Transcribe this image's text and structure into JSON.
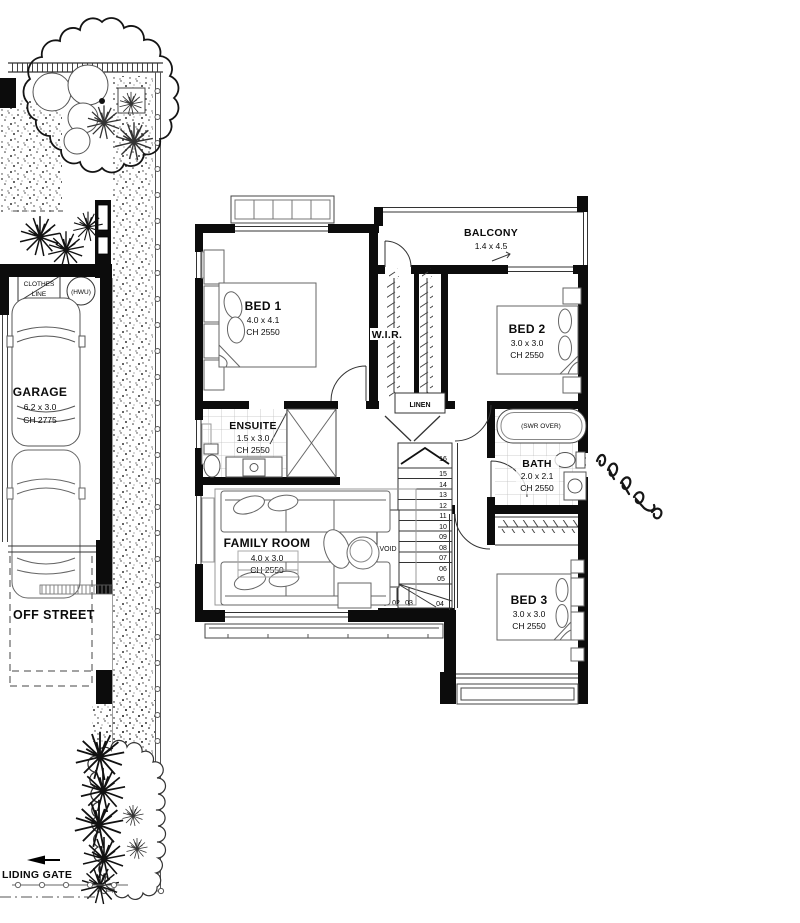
{
  "site": {
    "clothes_line_1": "CLOTHES",
    "clothes_line_2": "LINE",
    "hwu_label": "(HWU)",
    "garage_name": "GARAGE",
    "garage_size": "6.2 x 3.0",
    "garage_ch": "CH 2775",
    "off_street": "OFF STREET",
    "gate_label": "LIDING GATE"
  },
  "plan": {
    "balcony_name": "BALCONY",
    "balcony_size": "1.4 x 4.5",
    "bed1_name": "BED 1",
    "bed1_size": "4.0 x 4.1",
    "bed1_ch": "CH 2550",
    "bed2_name": "BED 2",
    "bed2_size": "3.0 x 3.0",
    "bed2_ch": "CH 2550",
    "bed3_name": "BED 3",
    "bed3_size": "3.0 x 3.0",
    "bed3_ch": "CH 2550",
    "family_name": "FAMILY ROOM",
    "family_size": "4.0 x 3.0",
    "family_ch": "CH 2550",
    "ensuite_name": "ENSUITE",
    "ensuite_size": "1.5 x 3.0",
    "ensuite_ch": "CH 2550",
    "bath_name": "BATH",
    "bath_size": "2.0 x 2.1",
    "bath_ch": "CH 2550",
    "wir": "W.I.R.",
    "linen": "LINEN",
    "void": "VOID",
    "swr": "(SWR OVER)",
    "stairs": [
      "01",
      "02",
      "03",
      "04",
      "05",
      "06",
      "07",
      "08",
      "09",
      "10",
      "11",
      "12",
      "13",
      "14",
      "15",
      "16"
    ]
  }
}
